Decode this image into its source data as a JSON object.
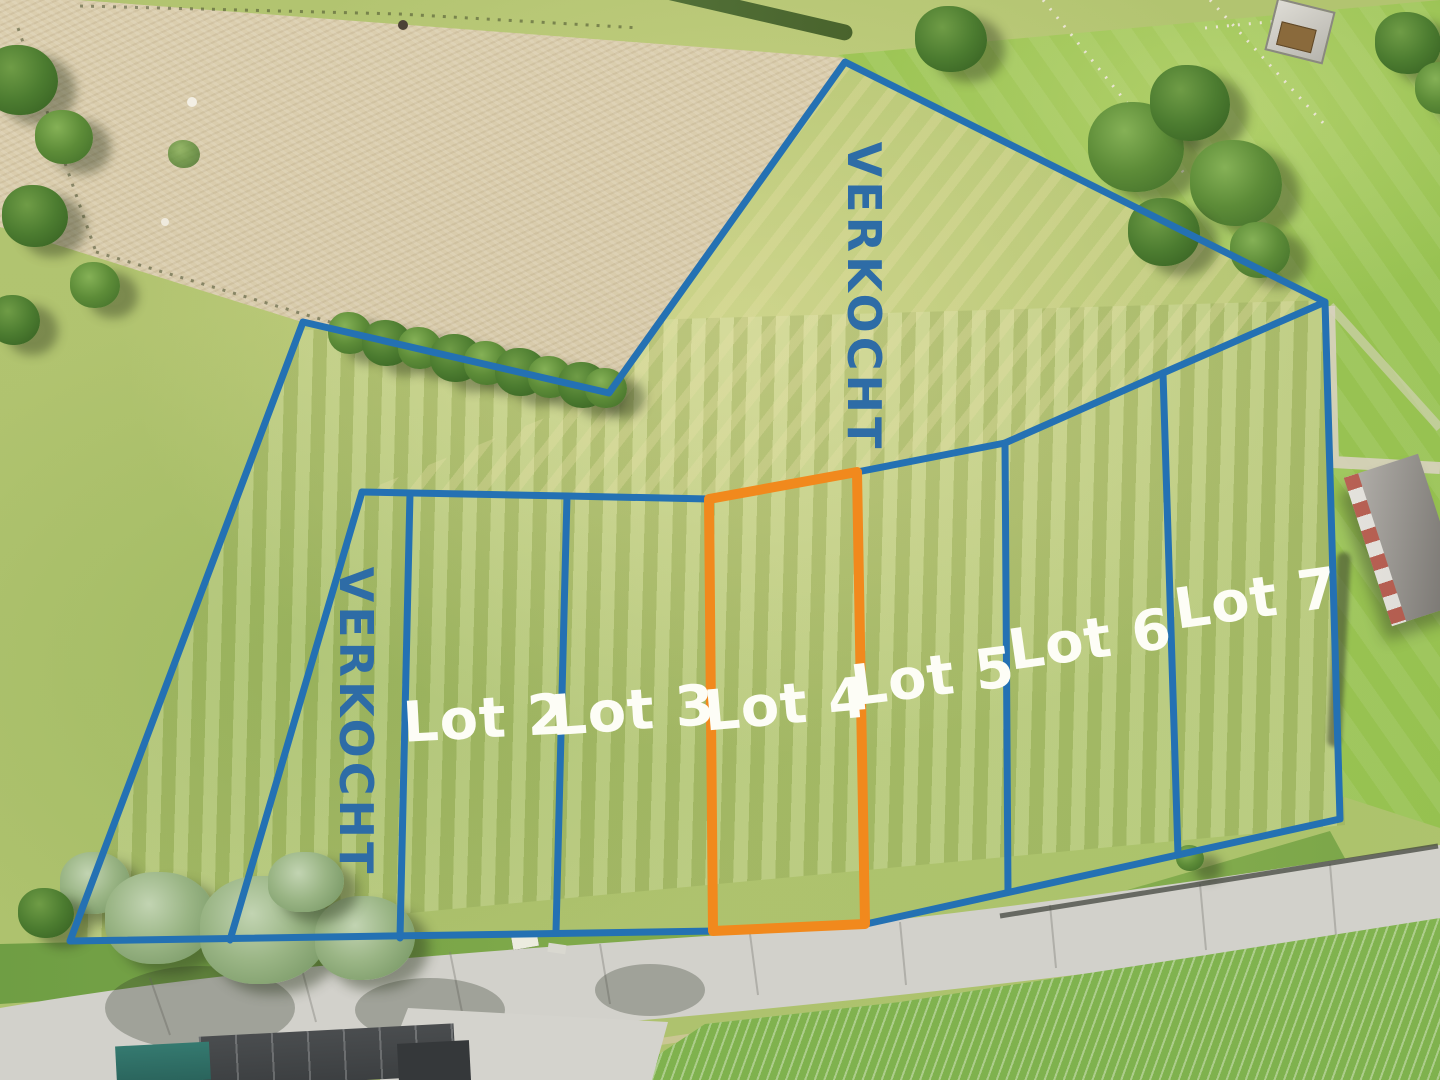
{
  "title": "Aerial building-lot plan with sold overlay",
  "overlay": {
    "sold_labels": [
      {
        "id": "sold-top",
        "text": "VERKOCHT"
      },
      {
        "id": "sold-left",
        "text": "VERKOCHT"
      }
    ],
    "lot_labels": [
      {
        "id": "lot-2",
        "text": "Lot 2"
      },
      {
        "id": "lot-3",
        "text": "Lot 3"
      },
      {
        "id": "lot-4",
        "text": "Lot 4"
      },
      {
        "id": "lot-5",
        "text": "Lot 5"
      },
      {
        "id": "lot-6",
        "text": "Lot 6"
      },
      {
        "id": "lot-7",
        "text": "Lot 7"
      }
    ]
  },
  "colors": {
    "boundary_blue": "#2471b3",
    "highlight_orange": "#f1891d",
    "sold_text": "#2e6ca6",
    "label_white": "#fdfdf6"
  }
}
